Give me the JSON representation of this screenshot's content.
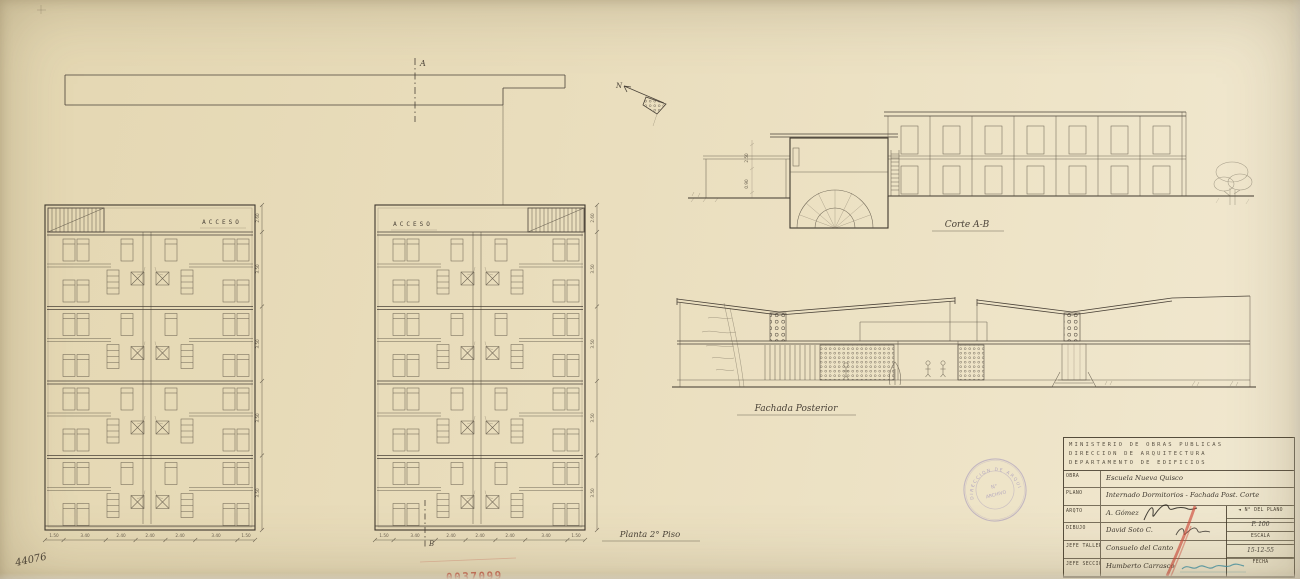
{
  "labels": {
    "axis_a": "A",
    "axis_b": "B",
    "north": "N",
    "acceso": "ACCESO",
    "corte_ab": "Corte A-B",
    "fachada_posterior": "Fachada Posterior",
    "planta_2_piso": "Planta 2° Piso",
    "sheet_number": "44076",
    "red_stamp_number": "0037099"
  },
  "dimensions": {
    "plan_side": [
      "2.60",
      "3.50",
      "3.50",
      "3.50",
      "3.50"
    ],
    "plan_bottom": [
      "1.50",
      "3.40",
      "2.40",
      "2.40",
      "2.40",
      "3.40",
      "1.50"
    ],
    "section": [
      "2.50",
      "0.90"
    ]
  },
  "title_block": {
    "ministry_lines": [
      "MINISTERIO DE OBRAS PUBLICAS",
      "DIRECCION DE ARQUITECTURA",
      "DEPARTAMENTO DE EDIFICIOS"
    ],
    "rows": [
      {
        "label": "OBRA",
        "value": "Escuela Nueva Quisco"
      },
      {
        "label": "PLANO",
        "value": "Internado Dormitorios - Fachada Post. Corte"
      },
      {
        "label": "ARQTO",
        "value": "A. Gómez"
      },
      {
        "label": "DIBUJO",
        "value": "David Soto C."
      },
      {
        "label": "JEFE TALLER",
        "value": "Consuelo del Canto"
      },
      {
        "label": "JEFE SECCION",
        "value": "Humberto Carrasco"
      }
    ],
    "side_arrow": "◄",
    "side_cells": [
      "N° DEL PLANO",
      "P. 100",
      "ESCALA",
      "15-12-55",
      "FECHA"
    ]
  },
  "stamp": {
    "ring_text": "DIRECCION DE ARQUITECTURA",
    "center_line1": "N°",
    "center_line2": "ARCHIVO"
  },
  "colors": {
    "paper": "#e9ddbc",
    "ink": "#4a4238",
    "stamp_purple": "#8779b8",
    "stamp_red": "#c7503f",
    "signature_teal": "#3f93a8"
  }
}
